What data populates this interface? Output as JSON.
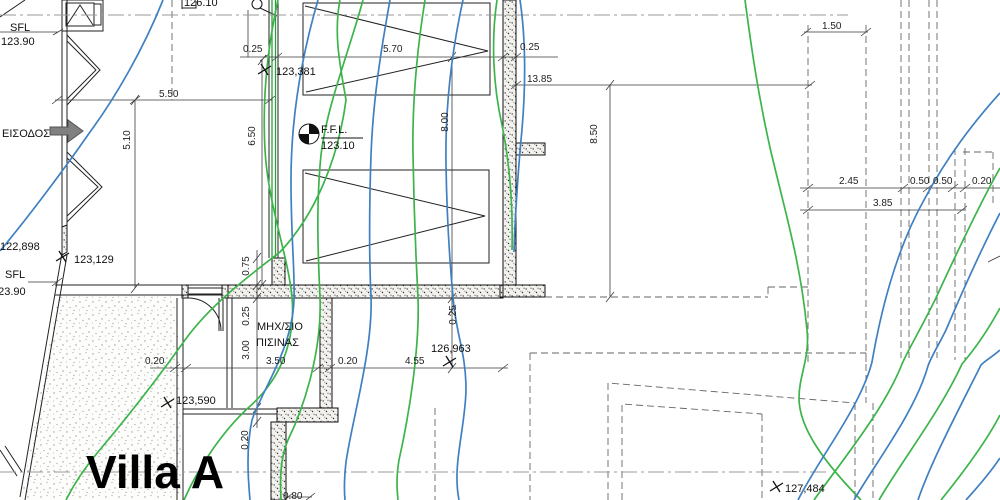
{
  "meta": {
    "drawing_title": "Villa A",
    "canvas": {
      "w": 1000,
      "h": 500
    },
    "colors": {
      "contour_green": "#3cb44a",
      "contour_blue": "#4080c1",
      "wall_outline": "#111111",
      "dim_line": "#3a3a3a",
      "dashed_line": "#666666",
      "axis_line": "#999999",
      "arrow_gray": "#808080"
    }
  },
  "texts": [
    {
      "t": "SFL",
      "x": 10,
      "y": 31,
      "s": 11,
      "k": "elev"
    },
    {
      "t": "123.90",
      "x": 1,
      "y": 45,
      "s": 11,
      "k": "elev"
    },
    {
      "t": "ΕΙΣΟΔΟΣ",
      "x": 2,
      "y": 137,
      "s": 11,
      "k": "room"
    },
    {
      "t": "122,898",
      "x": 0,
      "y": 250,
      "s": 11,
      "k": "elev"
    },
    {
      "t": "SFL",
      "x": 5,
      "y": 278,
      "s": 11,
      "k": "elev"
    },
    {
      "t": "123.90",
      "x": -8,
      "y": 295,
      "s": 11,
      "k": "elev"
    },
    {
      "t": "123,129",
      "x": 74,
      "y": 263,
      "s": 11,
      "k": "elev"
    },
    {
      "t": "123,381",
      "x": 276,
      "y": 75,
      "s": 11,
      "k": "elev"
    },
    {
      "t": "126.10",
      "x": 184,
      "y": 6,
      "s": 11,
      "k": "elev"
    },
    {
      "t": "0.25",
      "x": 243,
      "y": 52,
      "s": 10,
      "k": "dim"
    },
    {
      "t": "5.70",
      "x": 383,
      "y": 52,
      "s": 10,
      "k": "dim"
    },
    {
      "t": "0.25",
      "x": 520,
      "y": 50,
      "s": 10,
      "k": "dim"
    },
    {
      "t": "13.85",
      "x": 527,
      "y": 82,
      "s": 10,
      "k": "dim"
    },
    {
      "t": "1.50",
      "x": 822,
      "y": 29,
      "s": 10,
      "k": "dim"
    },
    {
      "t": "5.50",
      "x": 159,
      "y": 97,
      "s": 10,
      "k": "dim"
    },
    {
      "t": "F.F.L.",
      "x": 321,
      "y": 133,
      "s": 11,
      "k": "elev"
    },
    {
      "t": "123.10",
      "x": 321,
      "y": 149,
      "s": 11,
      "k": "elev"
    },
    {
      "t": "2.45",
      "x": 839,
      "y": 184,
      "s": 10,
      "k": "dim"
    },
    {
      "t": "0.50",
      "x": 910,
      "y": 184,
      "s": 10,
      "k": "dim"
    },
    {
      "t": "0.50",
      "x": 933,
      "y": 184,
      "s": 10,
      "k": "dim"
    },
    {
      "t": "0.20",
      "x": 972,
      "y": 184,
      "s": 10,
      "k": "dim"
    },
    {
      "t": "3.85",
      "x": 873,
      "y": 206,
      "s": 10,
      "k": "dim"
    },
    {
      "t": "ΜΗΧ/ΣΙΟ",
      "x": 257,
      "y": 330,
      "s": 11,
      "k": "room"
    },
    {
      "t": "ΠΙΣΙΝΑΣ",
      "x": 256,
      "y": 346,
      "s": 11,
      "k": "room"
    },
    {
      "t": "3.50",
      "x": 266,
      "y": 364,
      "s": 10,
      "k": "dim"
    },
    {
      "t": "0.20",
      "x": 338,
      "y": 364,
      "s": 10,
      "k": "dim"
    },
    {
      "t": "4.55",
      "x": 405,
      "y": 364,
      "s": 10,
      "k": "dim"
    },
    {
      "t": "126,963",
      "x": 431,
      "y": 352,
      "s": 11,
      "k": "elev"
    },
    {
      "t": "0.20",
      "x": 145,
      "y": 364,
      "s": 10,
      "k": "dim"
    },
    {
      "t": "123,590",
      "x": 176,
      "y": 404,
      "s": 11,
      "k": "elev"
    },
    {
      "t": "Villa A",
      "x": 86,
      "y": 488,
      "s": 46,
      "k": "title"
    },
    {
      "t": "0.80",
      "x": 283,
      "y": 499,
      "s": 10,
      "k": "dim"
    },
    {
      "t": "127,484",
      "x": 785,
      "y": 492,
      "s": 11,
      "k": "elev"
    },
    {
      "t": "5.10",
      "x": 130,
      "y": 140,
      "s": 10,
      "k": "dim",
      "rot": -90
    },
    {
      "t": "6.50",
      "x": 255,
      "y": 136,
      "s": 10,
      "k": "dim",
      "rot": -90
    },
    {
      "t": "8.00",
      "x": 448,
      "y": 122,
      "s": 10,
      "k": "dim",
      "rot": -90
    },
    {
      "t": "8.50",
      "x": 597,
      "y": 134,
      "s": 10,
      "k": "dim",
      "rot": -90
    },
    {
      "t": "0.75",
      "x": 249,
      "y": 266,
      "s": 10,
      "k": "dim",
      "rot": -90
    },
    {
      "t": "0.25",
      "x": 249,
      "y": 316,
      "s": 10,
      "k": "dim",
      "rot": -90
    },
    {
      "t": "3.00",
      "x": 249,
      "y": 350,
      "s": 10,
      "k": "dim",
      "rot": -90
    },
    {
      "t": "0.25",
      "x": 456,
      "y": 315,
      "s": 10,
      "k": "dim",
      "rot": -90
    },
    {
      "t": "0.20",
      "x": 248,
      "y": 440,
      "s": 10,
      "k": "dim",
      "rot": -90
    }
  ],
  "layers": [
    {
      "name": "terrace-stipple",
      "stroke": "none",
      "width": 0,
      "fill": "url(#stipple)",
      "d": "M58,296 L177,296 L182,500 L21,500 Z"
    },
    {
      "name": "hatched-walls",
      "stroke": "#111111",
      "width": 1,
      "fill": "url(#sand)",
      "d": "M503,0 h13 v285 h-13 Z M516,143 h29 v12 h-29 Z M500,285 h45 v12 h-45 Z M228,285 h275 v13 h-275 Z M182,285 h6 v13 h-6 Z M222,285 h6 v13 h-6 Z M320,298 h12 v110 h-12 Z M277,408 h61 v14 h-61 Z M271,422 h15 v78 h-15 Z M272,258 h13 v27 h-13 Z M62,227 L67,225 L67,252 L62,255 Z"
    },
    {
      "name": "thin-walls",
      "stroke": "#222222",
      "width": 1,
      "fill": "none",
      "d": "M62,0 V253 M67,0 V225 M62,253 L20,497 M67,255 L25,500 M55,285 H222 M55,295 H222 M177,298 V500 M183,298 V500 M67,35 L100,70 L67,105 M67,41 L96,70 L67,99 M67,152 L102,187 L67,222 M67,158 L98,187 L67,216 M62,0 H103 V31 H62 Z M66,3 H94 V26 H66 Z M67,25 L80,5 L93,25 M94,4 H101 V25 H94 Z M303,3 H490 V95 H303 Z M305,6 L488,51 L306,92 M303,170 H489 V263 H303 Z M305,173 L485,216 L306,261 M269,0 V258 M278,0 V258 M219,298 V331 M223,298 V331 M188,288 H222 M188,294 H222 M188,298 A33,33 0 0 1 221,331 M227,298 V408 M232,298 V408 M183,409 H277 M183,414 H277 M25,0 L0,17 M0,450 L17,476 M5,446 L22,472 M182,9 V0 M182,8 H196 V1 M260,8 L277,16"
    },
    {
      "name": "glazing",
      "stroke": "#2e9e3e",
      "width": 1.3,
      "fill": "none",
      "d": "M272,0 V258 M275.5,0 V258"
    },
    {
      "name": "dimension-lines",
      "stroke": "#3a3a3a",
      "width": 0.8,
      "fill": "none",
      "d": "M240,57 H558 M55,100 H272 M135,100 V288 M262,60 V285 M452,57 V368 M513,85 H812 M610,85 V297 M804,32 H868 M800,188 H1000 M800,210 H966 M150,368 H508 M257,250 V428 M0,32 H58 M28,282 H58 M286,497 H312 M248,10 V57 M988,262 L1000,256 M260,61 L270,53 M272,61 L282,53 M498,61 L508,53 M511,61 L521,53 M52,104 L62,96 M130,104 L140,96 M265,104 L275,96 M511,89 L521,81 M805,89 L815,81 M801,36 L811,28 M861,36 L871,28 M803,192 L813,184 M898,192 L908,184 M923,192 L933,184 M948,192 L958,184 M960,192 L970,184 M803,214 L813,206 M957,214 L967,206 M170,372 L180,364 M181,372 L191,364 M313,372 L323,364 M325,372 L335,364 M498,372 L508,364 M283,501 L293,493 M305,501 L315,493 M53,35 L63,29 M52,286 L62,278 M253,263 L261,253 M253,290 L261,280 M253,303 L261,293 M253,413 L261,403 M253,427 L261,417 M448,62 L456,52 M448,303 L456,293 M448,315 L456,305 M448,373 L456,363 M131,105 L139,95 M131,293 L139,283 M258,65 L266,55 M258,290 L266,280 M606,90 L614,80 M606,302 L614,292"
    },
    {
      "name": "dashed-lines",
      "stroke": "#666666",
      "width": 0.9,
      "fill": "none",
      "dash": "7 4",
      "d": "M172,0 V100 M808,25 V362 M866,25 V362 M901,0 V358 M909,0 V358 M929,0 V358 M937,0 V358 M955,148 V360 M965,148 V360 M963,152 H993 M993,152 V205 M545,297 H768 M768,287 V297 M768,287 H808 M530,353 H866 M866,353 V403 M530,353 V500 M608,500 V383 L855,403 M855,403 V500 M622,500 V404 L762,414 M762,414 V500 M873,403 V500 M435,408 V500"
    },
    {
      "name": "axis-dashdot",
      "stroke": "#999999",
      "width": 1,
      "fill": "none",
      "dash": "16 4 3 4",
      "d": "M0,15 H848 M0,472 H830"
    },
    {
      "name": "contours-green",
      "stroke": "#3cb44a",
      "width": 1.7,
      "fill": "none",
      "d": "M340,0 C333,35 341,70 346,100 C338,160 315,215 280,252 C250,275 210,305 185,340 C158,378 125,420 98,452 C83,470 73,486 66,500 M278,0 C268,45 262,95 265,150 C268,205 288,255 292,297 C296,345 278,382 248,408 C222,432 198,468 184,500 M363,0 C348,55 327,105 321,155 C316,205 318,255 320,297 C322,350 305,405 288,440 C280,458 280,480 281,500 M425,0 C417,50 412,100 413,155 C414,215 416,260 418,297 C420,350 408,420 399,460 C396,478 397,490 398,500 M497,0 C491,40 493,85 502,125 C510,165 513,210 512,250 M745,0 C751,45 758,95 771,152 C786,215 801,265 807,330 C810,358 799,375 799,398 C799,428 824,462 861,500 M1000,168 C984,196 958,250 935,300 C917,336 908,350 902,364 C884,410 841,462 814,500 M1000,308 C988,330 974,350 962,364 C940,412 901,462 879,500 M1000,415 C986,442 962,474 941,500"
    },
    {
      "name": "contours-blue",
      "stroke": "#4080c1",
      "width": 1.7,
      "fill": "none",
      "d": "M163,0 C143,50 115,98 90,132 C65,168 30,215 0,251 M318,0 C302,55 291,115 291,180 C291,240 295,270 294,300 C292,350 262,390 252,420 C246,448 248,478 250,500 M390,0 C381,50 373,100 371,155 C369,215 369,255 371,297 C373,350 352,420 346,462 C344,480 344,490 345,500 M463,0 C452,50 445,105 446,165 C447,225 450,265 453,297 C456,335 466,352 466,390 C465,430 452,465 459,500 M520,0 C526,40 526,90 521,140 C517,185 515,220 514,252 M1000,93 C974,122 948,155 924,200 C896,250 881,310 872,362 C860,408 821,455 798,500 M1000,213 C984,244 963,290 946,330 C936,350 931,357 928,366 C915,412 876,462 854,500 M1000,350 C992,357 986,360 981,365 C956,415 931,462 918,500 M1000,458 C990,473 976,489 966,500"
    },
    {
      "name": "spot-elevation-markers",
      "stroke": "#111111",
      "width": 1.3,
      "fill": "none",
      "d": "M258,74 L271,66 M261,64 L268,75 M56,261 L69,253 M59,251 L66,262 M161,407 L174,399 M164,397 L171,408 M443,366 L456,358 M446,356 L453,367 M770,491 L783,483 M773,481 L780,492"
    },
    {
      "name": "ffl-symbol",
      "stroke": "#111111",
      "width": 1,
      "fill": "none",
      "d": "M321,138 H363"
    },
    {
      "name": "ffl-symbol-fill",
      "stroke": "none",
      "width": 0,
      "fill": "#111111",
      "d": "M309,134 L309,124 A10,10 0 0 1 319,134 Z M309,134 L309,144 A10,10 0 0 1 299,134 Z"
    },
    {
      "name": "entrance-arrow",
      "stroke": "#555555",
      "width": 1,
      "fill": "#808080",
      "d": "M50,127 L68,127 L68,120 L83,131 L68,142 L68,135 L50,135 Z"
    }
  ],
  "circles": [
    {
      "name": "ffl-circle",
      "cx": 309,
      "cy": 134,
      "r": 10
    },
    {
      "name": "level-flag-circle",
      "cx": 257,
      "cy": 4,
      "r": 5
    }
  ]
}
